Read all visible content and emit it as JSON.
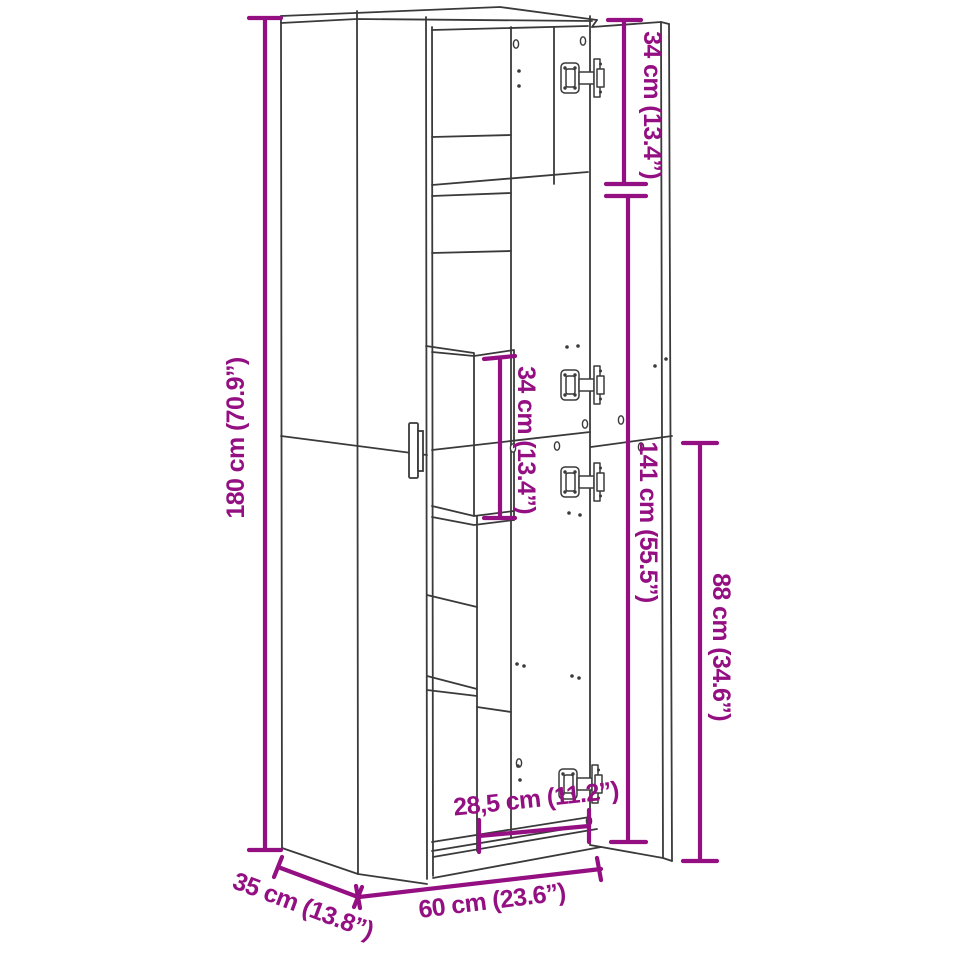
{
  "diagram": {
    "type": "furniture dimension diagram",
    "subject": "tall highboard storage cabinet shown with doors open",
    "colors": {
      "accent": "#930f82",
      "line": "#3a3a3a",
      "background": "#ffffff"
    },
    "dimensions": {
      "height": "180 cm (70.9”)",
      "top_compartment_height": "34 cm (13.4”)",
      "shelf_compartment_height": "34 cm (13.4”)",
      "door_section_height": "141 cm (55.5”)",
      "lower_door_height": "88 cm (34.6”)",
      "inner_width": "28,5 cm (11.2”)",
      "width": "60 cm (23.6”)",
      "depth": "35 cm (13.8”)"
    }
  }
}
